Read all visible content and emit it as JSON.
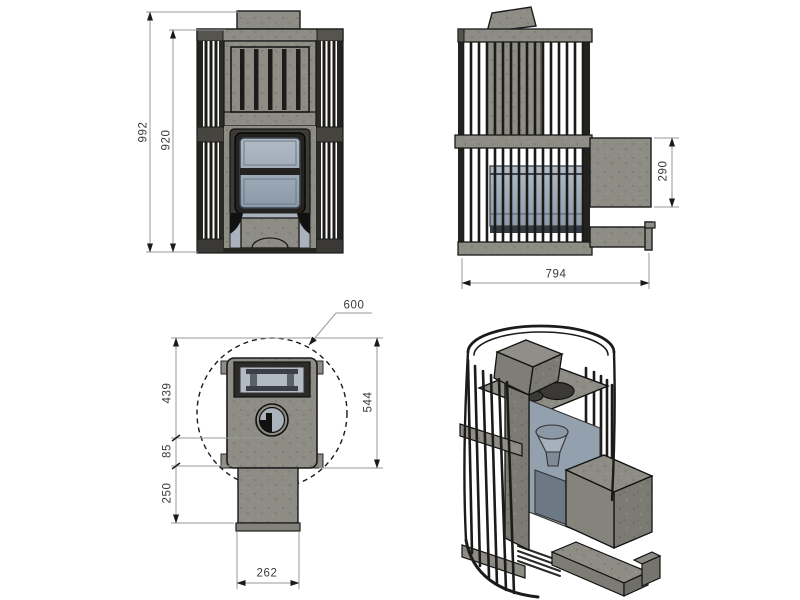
{
  "drawing": {
    "type": "technical-drawing-4-views",
    "subject": "wood-burning sauna stove with stone cage"
  },
  "views": {
    "front": {
      "dims": {
        "total_height": "992",
        "body_height": "920"
      }
    },
    "side": {
      "dims": {
        "tunnel_height": "290",
        "total_depth": "794"
      }
    },
    "top": {
      "dims": {
        "diameter": "600",
        "front_depth": "439",
        "door_offset": "85",
        "tunnel_length": "250",
        "body_depth": "544",
        "tunnel_width": "262"
      }
    },
    "cutaway": {
      "dims": {}
    }
  },
  "colors": {
    "background": "#ffffff",
    "stone": "#8e8d85",
    "stone_dark": "#6f6e67",
    "frame_dark": "#23221f",
    "glass": "#9fadba",
    "outline": "#1a1a1a",
    "dim_line": "#9a9a9a",
    "dim_text": "#3a3a3a"
  }
}
